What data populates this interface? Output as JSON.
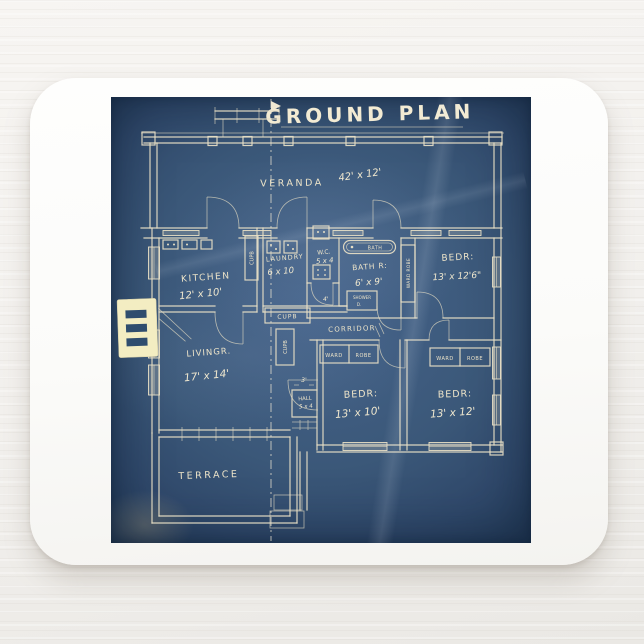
{
  "scene": {
    "backdrop_color": "#f1efec",
    "pad_color": "#fbfbf9"
  },
  "blueprint": {
    "title": "GROUND PLAN",
    "paper_color": "#3b5879",
    "ink_color": "#e8dfc5",
    "highlight_color": "#f3edc2",
    "rooms": {
      "veranda": {
        "name": "VERANDA",
        "dims": "42' x 12'"
      },
      "kitchen": {
        "name": "KITCHEN",
        "dims": "12' x 10'"
      },
      "laundry": {
        "name": "LAUNDRY",
        "dims": "6 x 10"
      },
      "wc": {
        "name": "W.C.",
        "dims": "5 x 4"
      },
      "bath": {
        "name": "BATH R:",
        "dims": "6' x 9'"
      },
      "bed_top_right": {
        "name": "BEDR:",
        "dims": "13' x 12'6\""
      },
      "living": {
        "name": "LIVINGR.",
        "dims": "17' x 14'"
      },
      "corridor": {
        "name": "CORRIDOR"
      },
      "hall": {
        "name": "HALL",
        "dims": "5 x 4"
      },
      "bed_bottom_left": {
        "name": "BEDR:",
        "dims": "13' x 10'"
      },
      "bed_bottom_right": {
        "name": "BEDR:",
        "dims": "13' x 12'"
      },
      "terrace": {
        "name": "TERRACE"
      }
    },
    "fixtures": {
      "tub": "BATH",
      "shower_line1": "SHOWER",
      "shower_line2": "D.",
      "cupboard": "CUPB",
      "wardrobe_vertical": "WARD ROBE",
      "ward": "WARD",
      "robe": "ROBE"
    },
    "dimensions": {
      "three_ft": "3'",
      "four_ft": "4'"
    }
  }
}
